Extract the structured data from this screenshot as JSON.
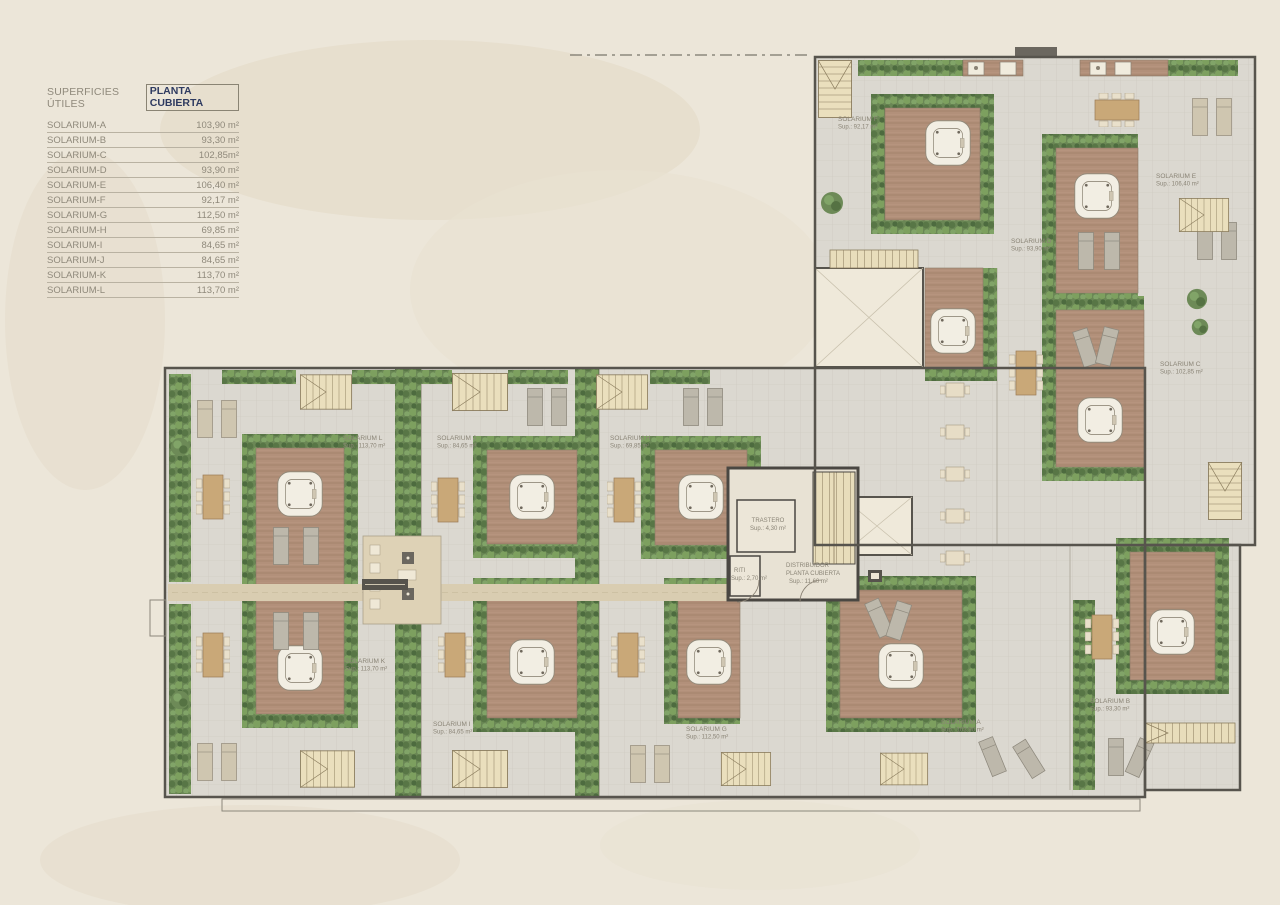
{
  "legend": {
    "title_label": "SUPERFICIES ÚTILES",
    "title_value": "PLANTA CUBIERTA",
    "rows": [
      {
        "label": "SOLARIUM-A",
        "value": "103,90 m²"
      },
      {
        "label": "SOLARIUM-B",
        "value": "93,30 m²"
      },
      {
        "label": "SOLARIUM-C",
        "value": "102,85m²"
      },
      {
        "label": "SOLARIUM-D",
        "value": "93,90 m²"
      },
      {
        "label": "SOLARIUM-E",
        "value": "106,40 m²"
      },
      {
        "label": "SOLARIUM-F",
        "value": "92,17 m²"
      },
      {
        "label": "SOLARIUM-G",
        "value": "112,50 m²"
      },
      {
        "label": "SOLARIUM-H",
        "value": "69,85 m²"
      },
      {
        "label": "SOLARIUM-I",
        "value": "84,65 m²"
      },
      {
        "label": "SOLARIUM-J",
        "value": "84,65 m²"
      },
      {
        "label": "SOLARIUM-K",
        "value": "113,70 m²"
      },
      {
        "label": "SOLARIUM-L",
        "value": "113,70 m²"
      }
    ]
  },
  "plan": {
    "labels": [
      {
        "name": "SOLARIUM L",
        "sup": "Sup.: 113,70 m²"
      },
      {
        "name": "SOLARIUM J",
        "sup": "Sup.: 84,65 m²"
      },
      {
        "name": "SOLARIUM H",
        "sup": "Sup.: 69,85 m²"
      },
      {
        "name": "SOLARIUM K",
        "sup": "Sup.: 113,70 m²"
      },
      {
        "name": "SOLARIUM I",
        "sup": "Sup.: 84,65 m²"
      },
      {
        "name": "SOLARIUM G",
        "sup": "Sup.: 112,50 m²"
      },
      {
        "name": "SOLARIUM A",
        "sup": "Sup.: 103,90 m²"
      },
      {
        "name": "SOLARIUM B",
        "sup": "Sup.: 93,30 m²"
      },
      {
        "name": "SOLARIUM F",
        "sup": "Sup.: 92,17 m²"
      },
      {
        "name": "SOLARIUM E",
        "sup": "Sup.: 106,40 m²"
      },
      {
        "name": "SOLARIUM D",
        "sup": "Sup.: 93,90 m²"
      },
      {
        "name": "SOLARIUM C",
        "sup": "Sup.: 102,85 m²"
      }
    ],
    "core": {
      "trastero_name": "TRASTERO",
      "trastero_sup": "Sup.: 4,30 m²",
      "riti_name": "RITI",
      "riti_sup": "Sup.: 2,70 m²",
      "distribuidor_line1": "DISTRIBUIDOR",
      "distribuidor_line2": "PLANTA CUBIERTA",
      "distribuidor_sup": "Sup.: 11,60 m²"
    }
  },
  "colors": {
    "background": "#ece6d9",
    "accent_navy": "#2e3a60",
    "wall": "#57544d",
    "floor_tile": "#dbd8d0",
    "wood_deck": "#b2907a",
    "hedge_green": "#6a8755",
    "walkway_tan": "#d9cdb1",
    "jacuzzi_cream": "#f2eee3",
    "legend_text": "#8f897b"
  }
}
